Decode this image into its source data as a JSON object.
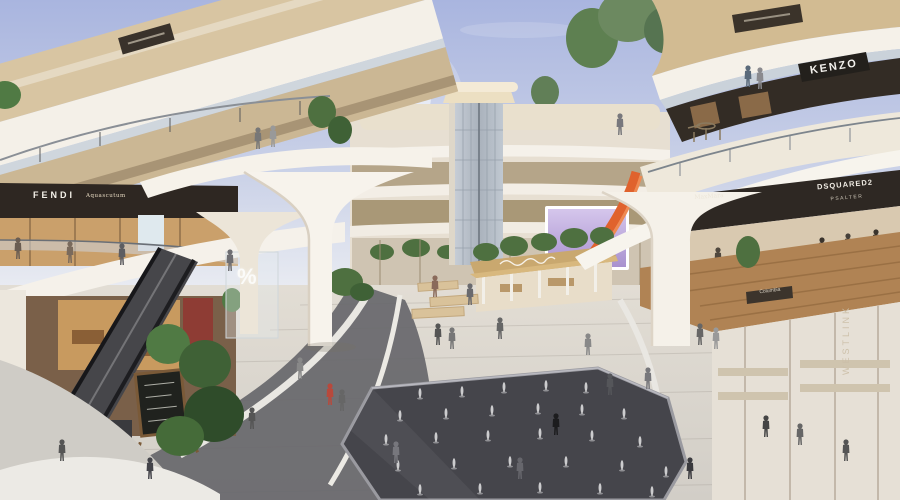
{
  "scene": {
    "title": "Shopping mall atrium rendering",
    "signs": {
      "fendi": "FENDI",
      "aquascutum": "Aquascutum",
      "kenzo": "KENZO",
      "maxmara": "MaxMara",
      "dsquared": "DSQUARED2",
      "psalter": "PSALTER",
      "westlink": "WESTLINK",
      "columbia": "Columbia",
      "sale_percent": "%"
    },
    "colors": {
      "sky_top": "#a9b5df",
      "sky_bottom": "#eceef3",
      "cream": "#f3efe6",
      "wood": "#c2a97f",
      "wood_dark": "#a8824f",
      "sign_dark": "#2c2620",
      "plaza": "#dcd8d1",
      "fountain_dark": "#47474d",
      "accent_orange": "#e0622d",
      "led_purple": "#c3b2e0",
      "plant_green": "#4e7040"
    }
  }
}
